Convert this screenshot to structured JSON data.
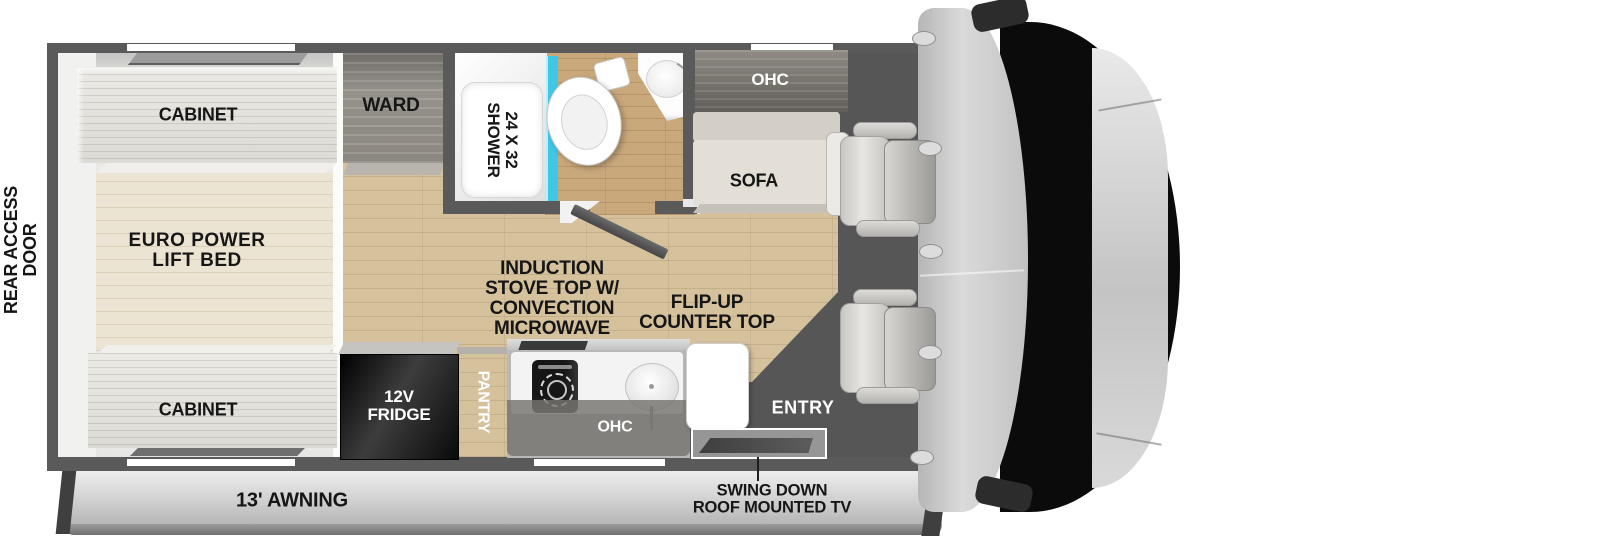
{
  "diagram": {
    "type": "rv-motorhome-floorplan",
    "labels": {
      "rear_access_door": [
        "REAR ACCESS",
        "DOOR"
      ],
      "cabinet_rear_top": "CABINET",
      "euro_power_lift_bed": [
        "EURO POWER",
        "LIFT BED"
      ],
      "cabinet_rear_bottom": "CABINET",
      "ward": "WARD",
      "shower": [
        "24 X 32",
        "SHOWER"
      ],
      "ohc_sofa": "OHC",
      "sofa": "SOFA",
      "fridge": [
        "12V",
        "FRIDGE"
      ],
      "pantry": "PANTRY",
      "induction_stove": [
        "INDUCTION",
        "STOVE TOP W/",
        "CONVECTION",
        "MICROWAVE"
      ],
      "flip_up_counter": [
        "FLIP-UP",
        "COUNTER TOP"
      ],
      "ohc_kitchen": "OHC",
      "entry": "ENTRY",
      "awning": "13' AWNING",
      "swing_down_tv": [
        "SWING DOWN",
        "ROOF MOUNTED TV"
      ]
    },
    "colors": {
      "wall": "#5a5a5a",
      "wood-floor": "#d5c19c",
      "bath-floor": "#c9a87b",
      "dark-floor": "#565656",
      "shower-glass": "#41c7e6",
      "fridge-black": "#121212",
      "label-black": "#161616",
      "label-white": "#ffffff",
      "awning-gray": "#c9c9c9",
      "cab-gray": "#c8c8c8",
      "windshield-black": "#0b0b0b"
    }
  }
}
